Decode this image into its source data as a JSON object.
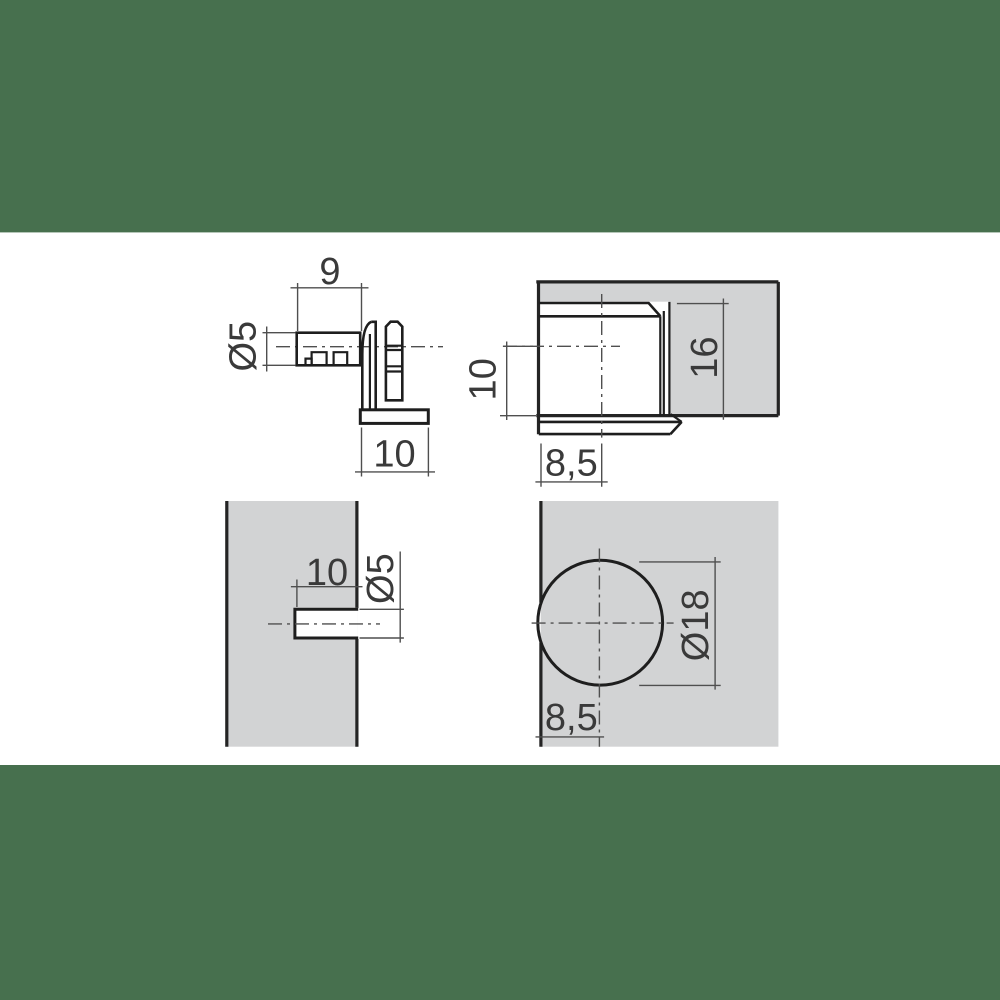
{
  "colors": {
    "band_green": "#47704e",
    "panel_gray": "#d2d3d4",
    "hole_white": "#ffffff",
    "part_line": "#1e1e1e",
    "dim_line": "#4f4f4f",
    "label_text": "#3a3a3a"
  },
  "views": {
    "fitting_side": {
      "pin_length": "9",
      "pin_diameter": "Ø5",
      "base_width": "10"
    },
    "installed_section": {
      "inset_depth": "10",
      "side_height": "16",
      "edge_distance": "8,5"
    },
    "panel_hole_side": {
      "hole_depth": "10",
      "hole_diameter": "Ø5"
    },
    "panel_hole_front": {
      "bore_diameter": "Ø18",
      "edge_distance": "8,5"
    }
  }
}
